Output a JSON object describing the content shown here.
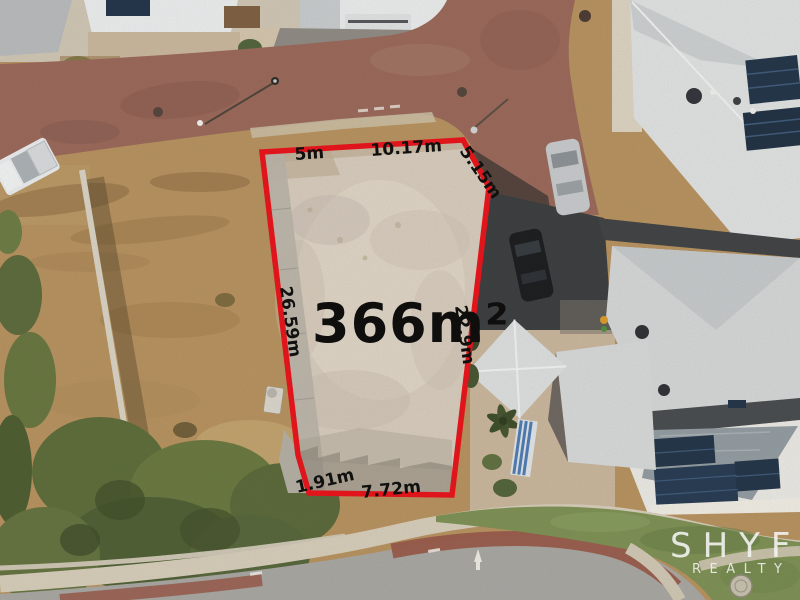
{
  "photo": {
    "description": "Aerial drone photo of a vacant residential land lot outlined for sale"
  },
  "lot": {
    "area": "366m²",
    "boundary_color": "#e8121a",
    "measurements": {
      "top_left": "5m",
      "top": "10.17m",
      "top_right_diagonal": "5.15m",
      "west": "26.59m",
      "east": "22.9m",
      "south_west": "1.91m",
      "south": "7.72m"
    }
  },
  "watermark": {
    "brand": "SHYFT",
    "tagline": "REALTY",
    "color": "#ffffff"
  },
  "scene_colors": {
    "brick_road": "#99685a",
    "asphalt_road": "#a7a6a2",
    "dry_grass": "#b6915f",
    "lot_sand": "#d6cbbc",
    "roof_gray": "#dfe1e2",
    "solar_panel": "#223449",
    "verge_green": "#7c9054"
  }
}
